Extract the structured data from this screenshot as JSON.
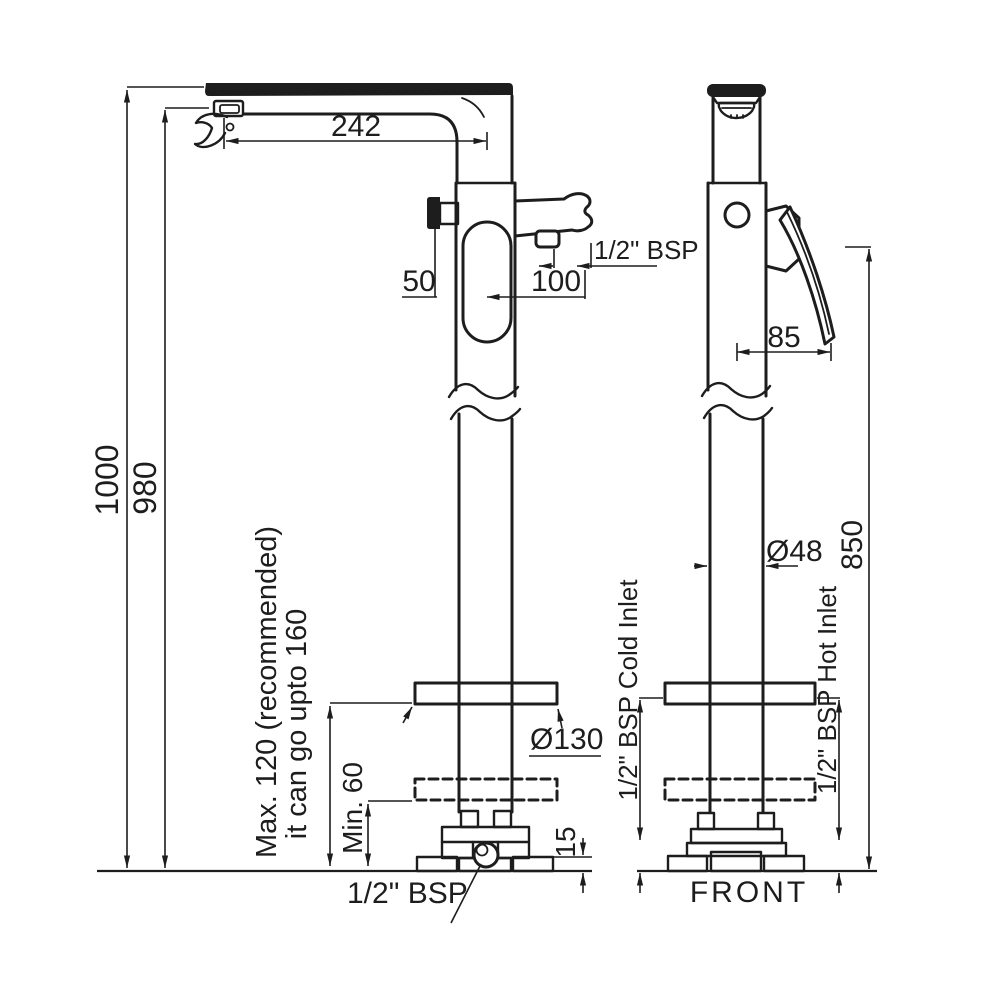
{
  "colors": {
    "ink": "#1d1d1d",
    "background": "#ffffff"
  },
  "labels": {
    "spout_reach": "242",
    "overall_height": "1000",
    "spout_height": "980",
    "knob_offset": "50",
    "hose_offset": "100",
    "hose_thread": "1/2\" BSP",
    "handle_length": "85",
    "pipe_diameter": "Ø48",
    "handle_height": "850",
    "flange_diameter": "Ø130",
    "adjust_note_line1": "Max. 120 (recommended)",
    "adjust_note_line2": "it can go upto 160",
    "min_note": "Min. 60",
    "base_height": "15",
    "cold_inlet": "1/2\" BSP Cold Inlet",
    "hot_inlet": "1/2\" BSP Hot Inlet",
    "base_thread": "1/2\" BSP",
    "front_view": "FRONT"
  }
}
